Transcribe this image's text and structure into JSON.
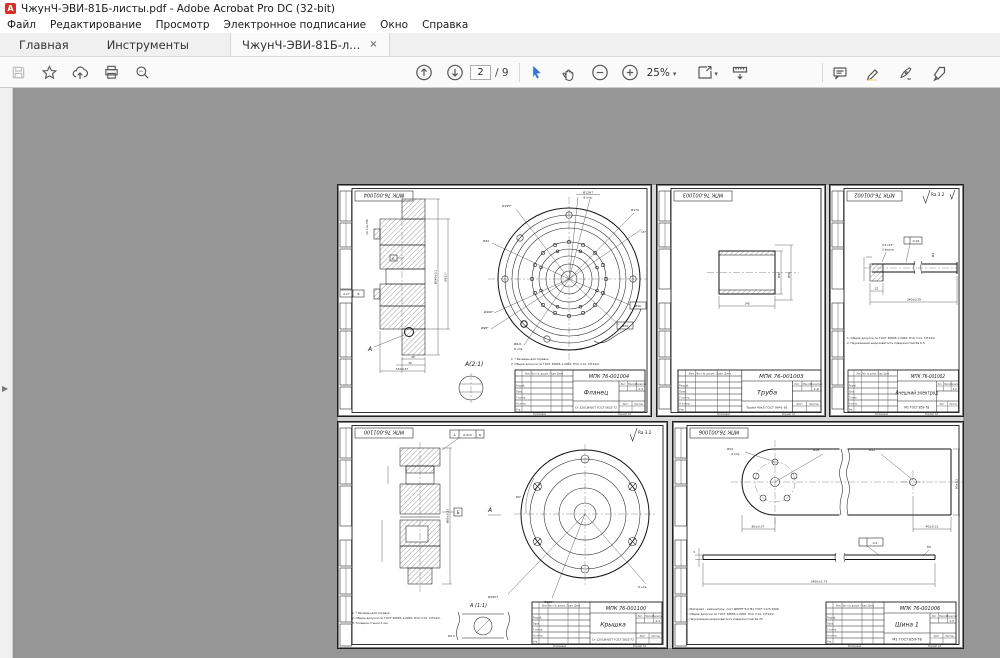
{
  "window_title": "ЧжунЧ-ЭВИ-81Б-листы.pdf - Adobe Acrobat Pro DC (32-bit)",
  "menu": {
    "items": [
      "Файл",
      "Редактирование",
      "Просмотр",
      "Электронное подписание",
      "Окно",
      "Справка"
    ]
  },
  "tabs": {
    "home": "Главная",
    "tools": "Инструменты",
    "doc": "ЧжунЧ-ЭВИ-81Б-л...",
    "close": "×"
  },
  "toolbar": {
    "page": "2",
    "page_total": "/ 9",
    "zoom": "25%"
  },
  "panel_arrow": "▶",
  "tb": {
    "header": "Изм. Лист  № докум.  Подп.  Дата",
    "r1": "Разраб.",
    "r2": "Пров.",
    "r3": "Т.контр.",
    "r4": "Н.контр.",
    "r5": "Утв.",
    "lit": "Лит.",
    "mass": "Масса",
    "scale_l": "Масштаб",
    "sheet_l": "Лист",
    "sheets_l": "Листов",
    "copy": "Копировал",
    "format": "Формат А4"
  },
  "sheets": [
    {
      "number": "МПК 76-001004",
      "name": "Фланец",
      "material": "Ст 12Х18Н10Т ГОСТ 5632-72",
      "scale": "1:1",
      "view": "А",
      "detail": "А(2:1)",
      "notes": [
        "1. * Размеры для справок.",
        "2. Общие допуски по ГОСТ 30893.1-2002: H14, h14, ±IT14/2."
      ],
      "labels": {
        "d1": "Ø12H7",
        "d2": "8 отв.",
        "d3": "Ø195*",
        "d4": "Ø170",
        "d5": "Ø32",
        "d6": "Ø160*",
        "d7": "Ø98*",
        "d8": "Ø6,6",
        "d9": "6 отв.",
        "d10": "Ø10",
        "d11": "Ø34",
        "d12": "15°",
        "d13": "Ø140±0.2",
        "d14": "Ø152*",
        "d15": "28",
        "d16": "30",
        "d17": "55±0.37",
        "d18": "20 отв. М6",
        "d19": "0.27",
        "d20": "Б"
      }
    },
    {
      "number": "МПК 76-001003",
      "name": "Труба",
      "material": "Труба 40х5 ГОСТ 9941-81",
      "scale": "1:2",
      "labels": {
        "d1": "Ø40",
        "d2": "Ø50",
        "d3": "140"
      }
    },
    {
      "number": "МПК 76-001002",
      "name": "Внешний электрод",
      "material": "М1 ГОСТ 859-78",
      "scale": "1:2",
      "ra": "Ra 3.2",
      "notes": [
        "1. Общие допуски по ГОСТ 30893.1-2002: H14, h14, ±IT14/2.",
        "2. Неуказанная шероховатость поверхностей Ra 6.3."
      ],
      "labels": {
        "d1": "22",
        "d2": "340±0.29",
        "d3": "Ø4",
        "d4": "0.5×45°",
        "d5": "2 фаски",
        "d6": "0.19"
      }
    },
    {
      "number": "МПК 76-001100",
      "name": "Крышка",
      "material": "Ст 12Х18Н10Т ГОСТ 5632-72",
      "scale": "1:1",
      "ra": "Ra 3.2",
      "view": "А",
      "detail": "А (1:1)",
      "sym": "⊥",
      "notes": [
        "1. * Размеры для справок.",
        "2. Общие допуски по ГОСТ 30893.1-2002: H14, h14, ±IT14/2.",
        "3. Толщина стенки 1 мм."
      ],
      "labels": {
        "d1": "0.013",
        "d2": "Б",
        "d3": "Ø10H7",
        "d4": "Ø102*",
        "d5": "6 отв.",
        "d6": "R0.5",
        "d7": "Ø85±0.11",
        "d8": "60°",
        "d9": "Б"
      }
    },
    {
      "number": "МПК 76-001006",
      "name": "Шина 1",
      "material": "М1 ГОСТ 859-78",
      "scale": "1:2",
      "notes": [
        "1. Материал - заменитель: лист ДПРНТ 8,0 М1 ГОСТ 1173-2006.",
        "2. Общие допуски по ГОСТ 30893.1-2002: H14, h14, ±IT14/2.",
        "3. Неуказанная шероховатость поверхностей Ra 25."
      ],
      "labels": {
        "d1": "Ø12",
        "d2": "4 отв.",
        "d3": "Ø28",
        "d4": "Ø12",
        "d5": "80±0.37",
        "d6": "40±0.31",
        "d7": "80±0.2",
        "d8": "3450±2.75",
        "d9": "R5",
        "d10": "3",
        "d11": "0.2"
      }
    }
  ]
}
